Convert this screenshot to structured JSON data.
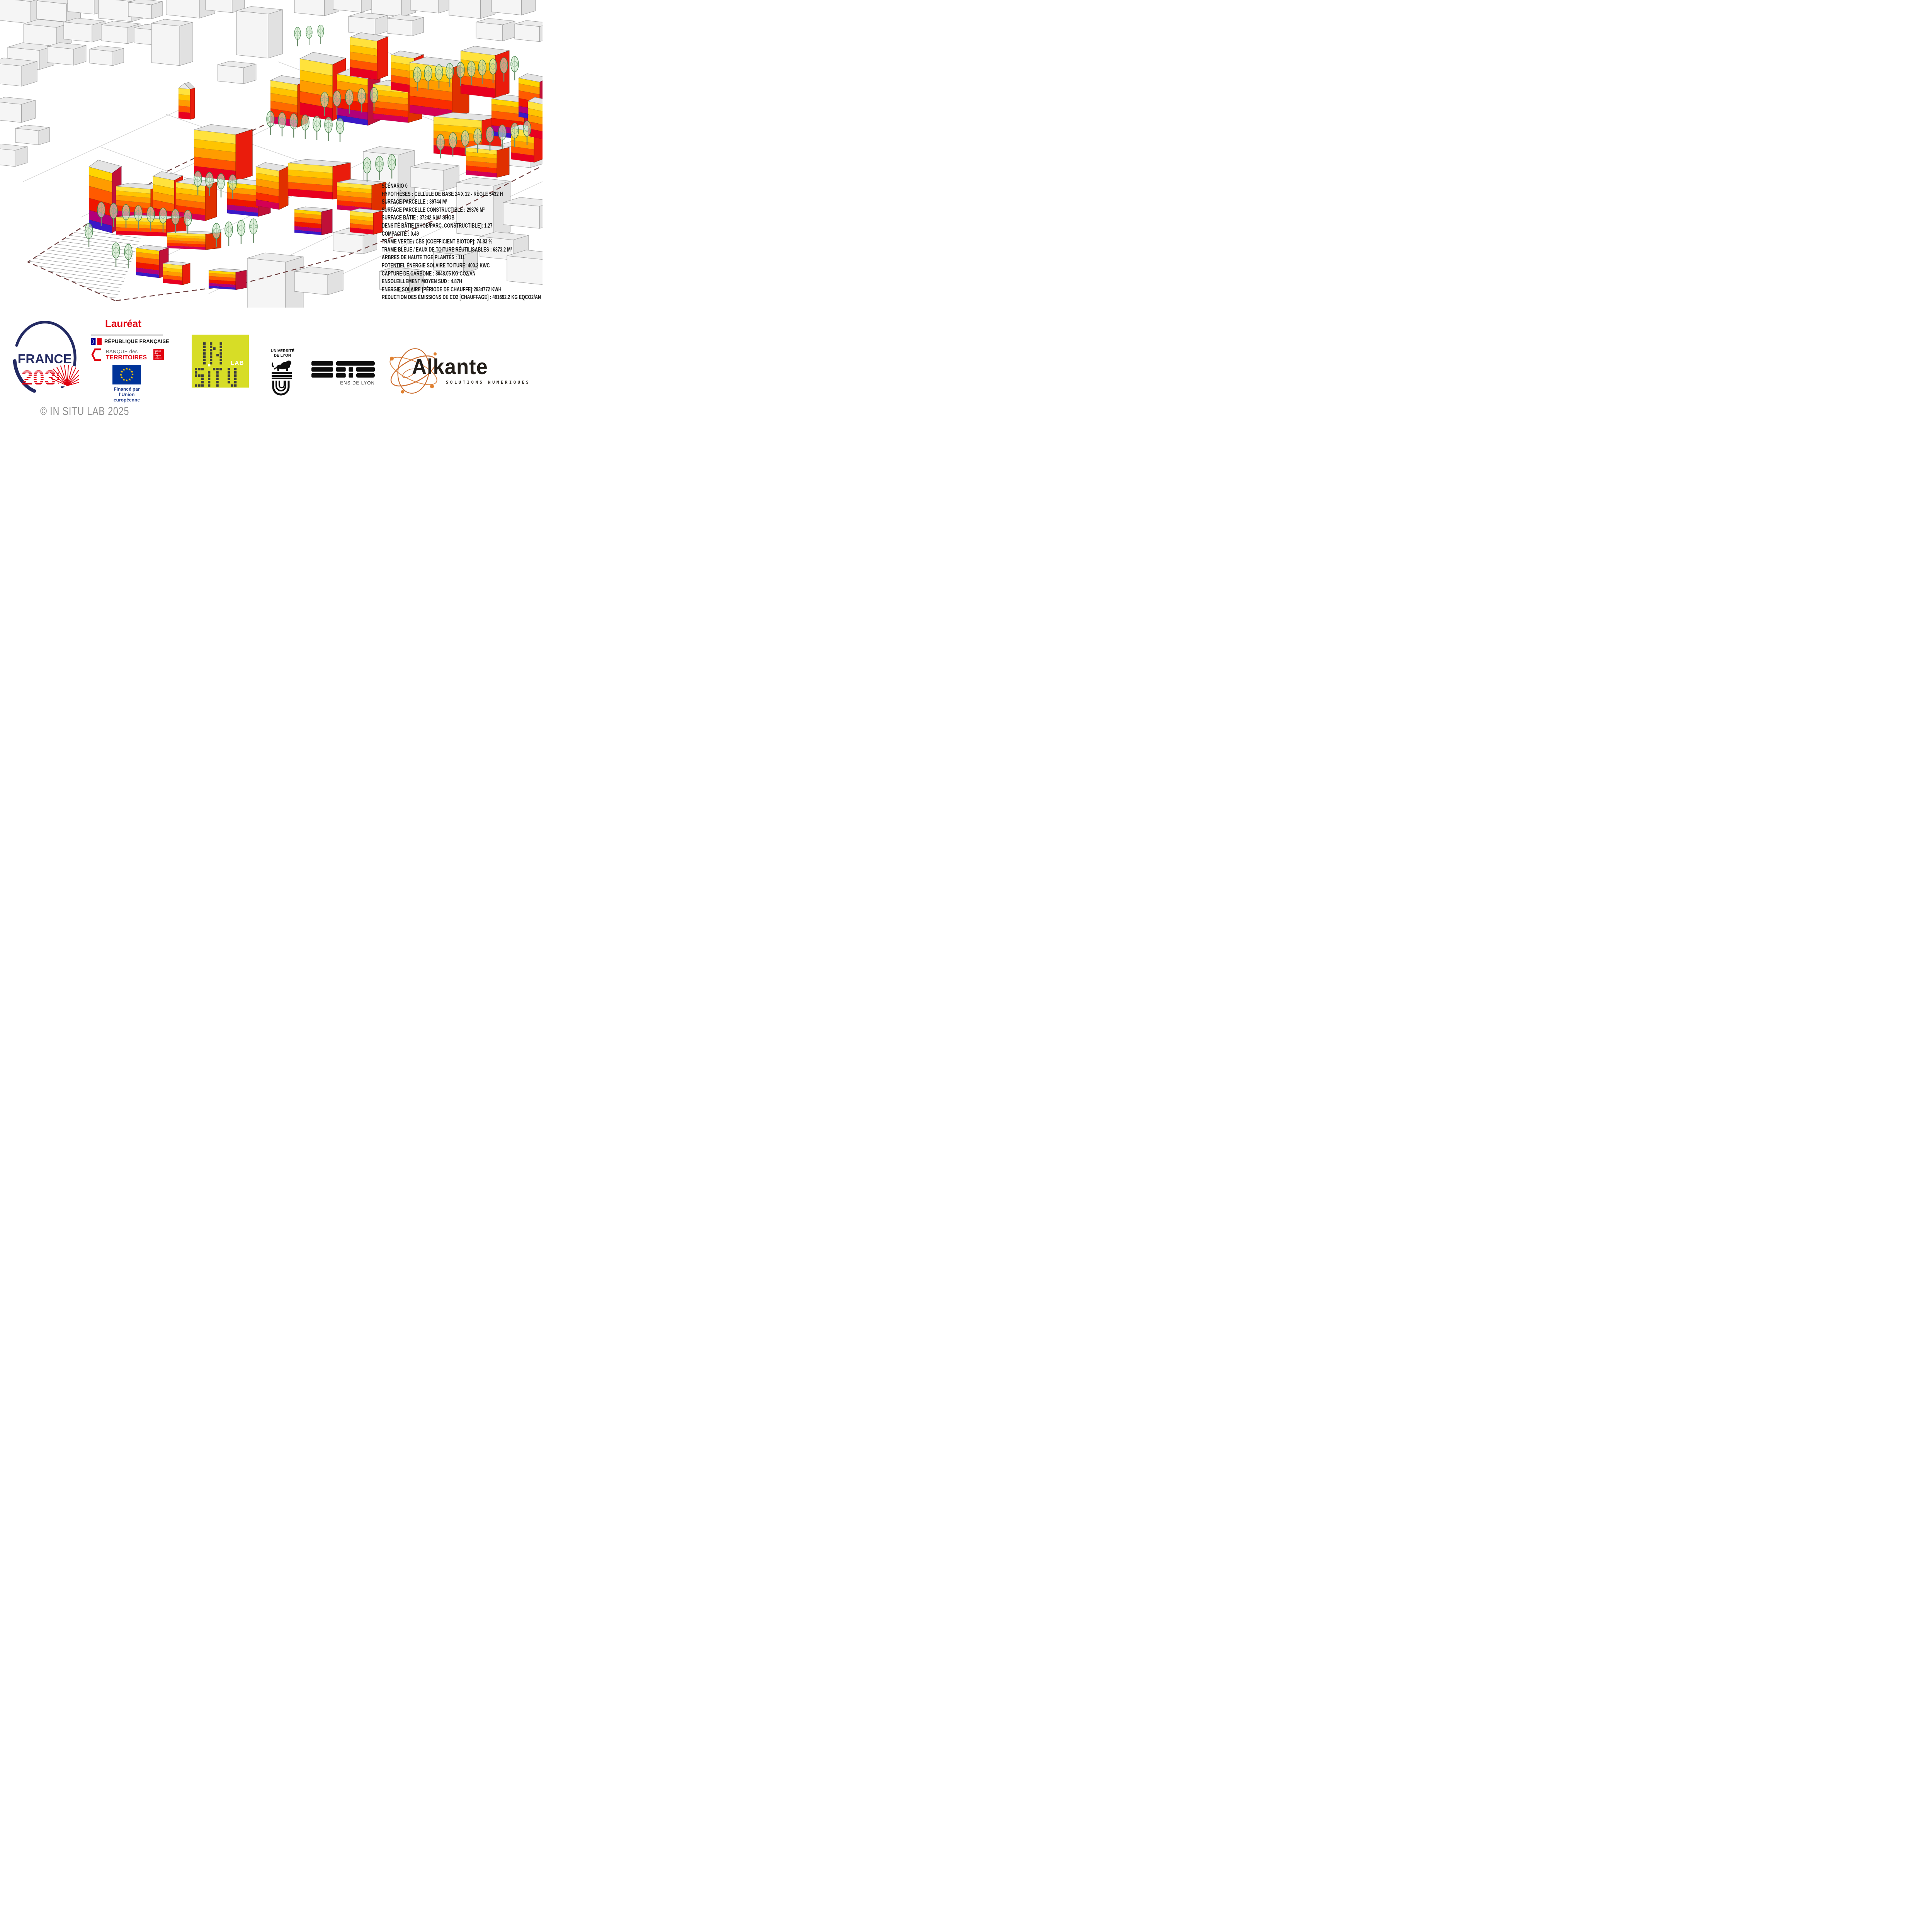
{
  "stats": {
    "lines": [
      "SCÉNARIO 0",
      "HYPOTHÈSES : CELLULE DE BASE 24 X 12 - RÈGLE 5432 H",
      "SURFACE PARCELLE : 39744 M²",
      "SURFACE PARCELLE CONSTRUCTIBLE : 29376 M²",
      "SURFACE BÂTIE : 37242.6 M² SHOB",
      "DENSITÉ BÂTIE [SHOB/PARC. CONSTRUCTIBLE]: 1.27",
      "COMPACITÉ : 0.49",
      "TRAME VERTE / CBS [COEFFICIENT BIOTOP]: 74.83 %",
      "TRAME BLEUE / EAUX DE TOITURE RÉUTILISABLES : 6373.2 M²",
      "ARBRES DE HAUTE TIGE PLANTÉS :  111",
      "POTENTIEL ÉNERGIE SOLAIRE TOITURE: 400.2 KWC",
      "CAPTURE DE CARBONE : 8048.05 KG CO2/AN",
      "ENSOLEILLEMENT MOYEN SUD : 4.87H",
      "ENERGIE SOLAIRE [PÉRIODE DE CHAUFFE]:2934772 KWH",
      "RÉDUCTION DES ÉMISSIONS DE CO2 [CHAUFFAGE] : 491692.2 KG EQCO2/AN"
    ]
  },
  "footer": {
    "laureat": "Lauréat",
    "france2030": {
      "word1": "FRANCE",
      "word2": "2030"
    },
    "republique": "RÉPUBLIQUE FRANÇAISE",
    "banque_territoires": {
      "line1": "BANQUE des",
      "line2": "TERRITOIRES"
    },
    "caisse_depots": {
      "line1": "Caisse",
      "line2": "des Dépôts",
      "line3": "GROUPE"
    },
    "eu": {
      "line1": "Financé par",
      "line2": "l’Union européenne"
    },
    "insitu": {
      "word1": "IN",
      "word2": "SITU",
      "lab": "LAB"
    },
    "universite_lyon": {
      "line1": "UNIVERSITÉ",
      "line2": "DE LYON"
    },
    "ens": {
      "logo": "ENS",
      "label": "ENS DE LYON"
    },
    "alkante": {
      "name": "Alkante",
      "tagline": "SOLUTIONS NUMÉRIQUES"
    }
  },
  "copyright": "© IN SITU LAB 2025",
  "colors": {
    "france_navy": "#232a63",
    "brand_red": "#e1000f",
    "eu_blue": "#003399",
    "eu_star_yellow": "#ffcc00",
    "insitu_yellow": "#d7dd26",
    "alkante_orange": "#cf7034",
    "facade_yellow": "#ffe23c",
    "facade_orange": "#ff9c00",
    "facade_red": "#f32300",
    "facade_purple": "#b1007a",
    "facade_blue": "#3a18c8",
    "tree_green": "#3f7d44"
  }
}
